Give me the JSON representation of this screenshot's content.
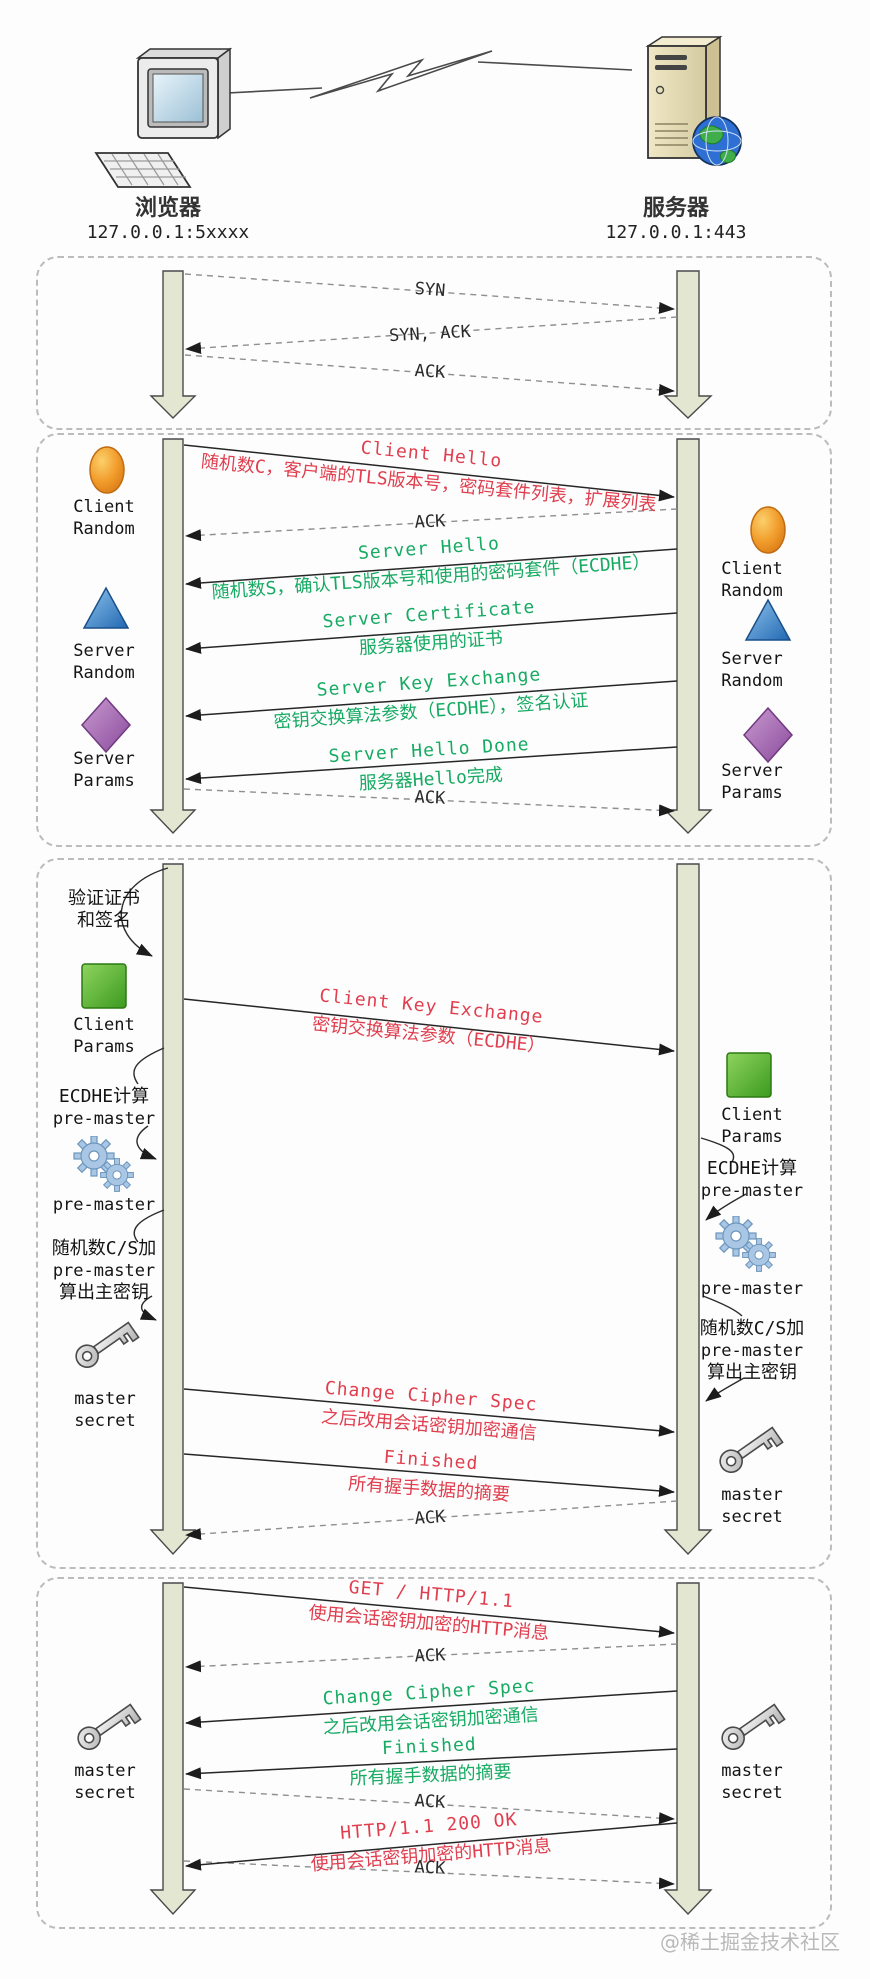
{
  "header": {
    "client": {
      "label": "浏览器",
      "address": "127.0.0.1:5xxxx"
    },
    "server": {
      "label": "服务器",
      "address": "127.0.0.1:443"
    }
  },
  "watermark": "@稀土掘金技术社区",
  "colors": {
    "red": "#e03e4e",
    "green": "#17aa63",
    "solid_line": "#262626",
    "dashed_line": "#8f8f8f",
    "lifeline_fill": "#e3e7d1"
  },
  "labels": {
    "client_random": "Client Random",
    "server_random": "Server Random",
    "server_params": "Server Params",
    "client_params": "Client Params",
    "master_secret": "master secret",
    "pre_master": "pre-master"
  },
  "box1": {
    "syn": "SYN",
    "syn_ack": "SYN, ACK",
    "ack": "ACK"
  },
  "box2": {
    "client_hello": {
      "title": "Client Hello",
      "sub": "随机数C，客户端的TLS版本号，密码套件列表，扩展列表"
    },
    "ack1": "ACK",
    "server_hello": {
      "title": "Server Hello",
      "sub": "随机数S，确认TLS版本号和使用的密码套件（ECDHE）"
    },
    "server_certificate": {
      "title": "Server Certificate",
      "sub": "服务器使用的证书"
    },
    "server_key_exchange": {
      "title": "Server Key Exchange",
      "sub": "密钥交换算法参数（ECDHE），签名认证"
    },
    "server_hello_done": {
      "title": "Server Hello Done",
      "sub": "服务器Hello完成"
    },
    "ack2": "ACK"
  },
  "box3": {
    "verify": [
      "验证证书",
      "和签名"
    ],
    "ecdhe": [
      "ECDHE计算",
      "pre-master"
    ],
    "calc": [
      "随机数C/S加",
      "pre-master",
      "算出主密钥"
    ],
    "client_key_exchange": {
      "title": "Client Key Exchange",
      "sub": "密钥交换算法参数（ECDHE）"
    },
    "change_cipher_spec": {
      "title": "Change Cipher Spec",
      "sub": "之后改用会话密钥加密通信"
    },
    "finished": {
      "title": "Finished",
      "sub": "所有握手数据的摘要"
    },
    "ack": "ACK"
  },
  "box4": {
    "get": {
      "title": "GET / HTTP/1.1",
      "sub": "使用会话密钥加密的HTTP消息"
    },
    "ack1": "ACK",
    "change_cipher_spec": {
      "title": "Change Cipher Spec",
      "sub": "之后改用会话密钥加密通信"
    },
    "finished": {
      "title": "Finished",
      "sub": "所有握手数据的摘要"
    },
    "ack2": "ACK",
    "http_200": {
      "title": "HTTP/1.1 200 OK",
      "sub": "使用会话密钥加密的HTTP消息"
    },
    "ack3": "ACK"
  }
}
